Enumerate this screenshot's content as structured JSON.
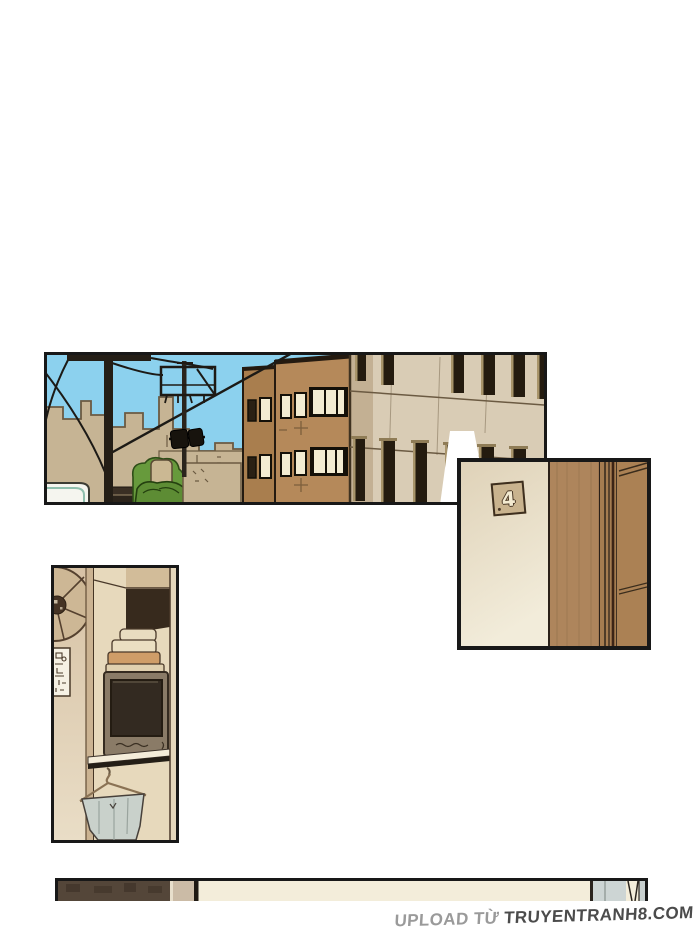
{
  "page": {
    "background": "#ffffff",
    "kind": "webtoon comic page"
  },
  "panels": {
    "street_scene": {
      "alt": "Street view: blue sky, utility poles with sagging power lines and loudspeakers, low tan background buildings, green bushes, a brown building with lit windows and a beige building with dark window slits"
    },
    "door_with_number": {
      "alt": "Cream door wall with a small tilted square plate numbered 4 next to a brown wooden door frame"
    },
    "kitchen_interior": {
      "alt": "Interior wall with a round ventilation fan, a small paper sign, folded cloths stacked on an old TV on a shelf, and a wire hanger holding a gray cloth basin"
    },
    "bottom_strip": {
      "alt": "Thin top sliver of the next panel: dark brown wall, tan post, cream wall and pale blue-gray cloth at right"
    }
  },
  "door_plate": {
    "number": "4"
  },
  "watermark": {
    "prefix": "UPLOAD TỪ",
    "site": "TRUYENTRANH8.COM"
  },
  "colors": {
    "panel_border": "#181818",
    "sky": "#8cd1ee",
    "background_buildings": "#c6b494",
    "bush": "#679a3c",
    "brown_building": "#b5895a",
    "beige_building": "#d9ccb5",
    "lit_window": "#f3ecd2",
    "door_cream_top": "#dfd2b8",
    "door_cream_bottom": "#f2ecda",
    "frame_wood": "#ae855c",
    "interior_wall": "#d7c2a5",
    "tv_body": "#8a7b67",
    "cloth_orange": "#cf9d68",
    "bucket_gray": "#c9d1cb",
    "strip_dark_brown": "#544639",
    "strip_cream": "#f3edda",
    "watermark_gray": "#9a9a9a",
    "watermark_dark": "#4b4b4b"
  }
}
